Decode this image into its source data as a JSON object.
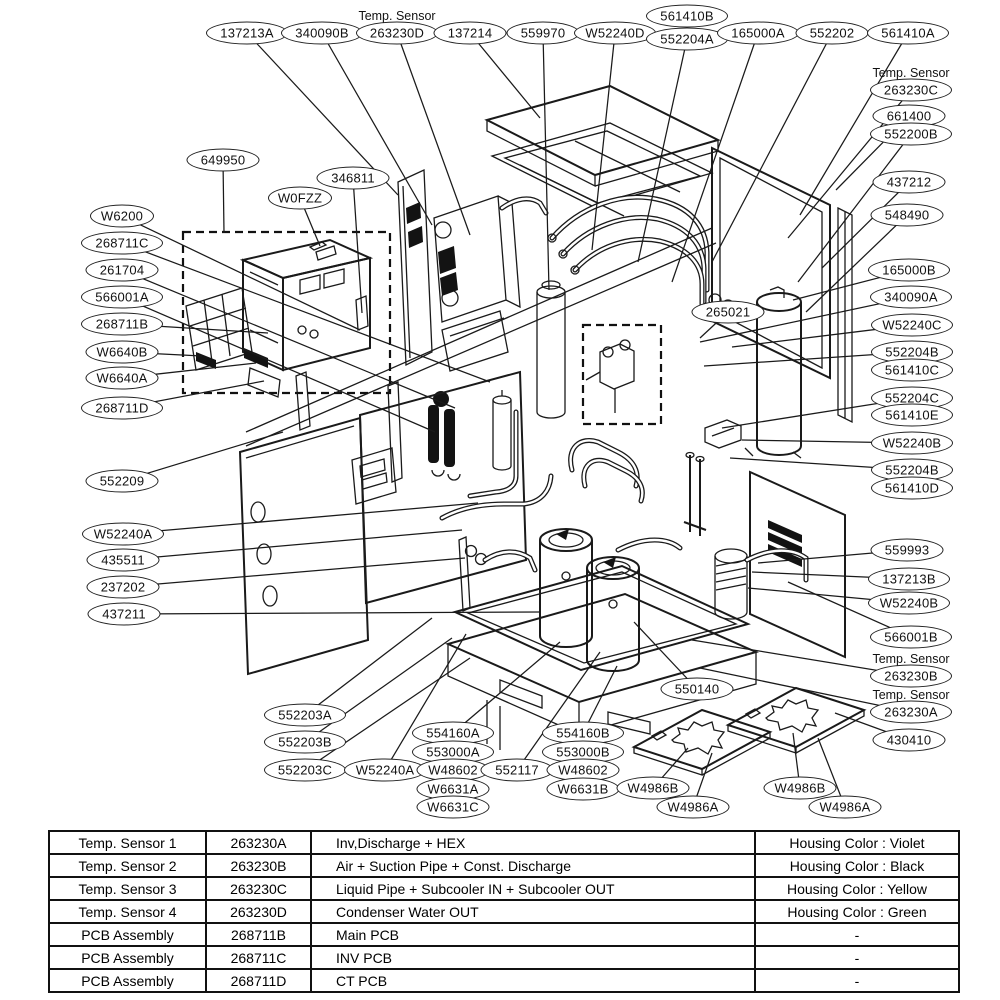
{
  "diagram": {
    "sensor_note_text": "Temp. Sensor",
    "labels": [
      {
        "text": "137213A",
        "x": 247,
        "y": 33,
        "lx": 398,
        "ly": 195
      },
      {
        "text": "340090B",
        "x": 322,
        "y": 33,
        "lx": 432,
        "ly": 225
      },
      {
        "text": "263230D",
        "x": 397,
        "y": 33,
        "note": true,
        "lx": 470,
        "ly": 235
      },
      {
        "text": "137214",
        "x": 470,
        "y": 33,
        "lx": 540,
        "ly": 118
      },
      {
        "text": "559970",
        "x": 543,
        "y": 33,
        "lx": 549,
        "ly": 290
      },
      {
        "text": "W52240D",
        "x": 615,
        "y": 33,
        "lx": 592,
        "ly": 250
      },
      {
        "text": "561410B",
        "x": 687,
        "y": 16
      },
      {
        "text": "552204A",
        "x": 687,
        "y": 39,
        "lx": 638,
        "ly": 262
      },
      {
        "text": "165000A",
        "x": 758,
        "y": 33,
        "lx": 672,
        "ly": 282
      },
      {
        "text": "552202",
        "x": 832,
        "y": 33,
        "lx": 712,
        "ly": 262
      },
      {
        "text": "561410A",
        "x": 908,
        "y": 33,
        "lx": 800,
        "ly": 215
      },
      {
        "text": "263230C",
        "x": 911,
        "y": 90,
        "note": true,
        "lx": 788,
        "ly": 238
      },
      {
        "text": "661400",
        "x": 909,
        "y": 116,
        "lx": 836,
        "ly": 190
      },
      {
        "text": "552200B",
        "x": 911,
        "y": 134,
        "lx": 798,
        "ly": 282
      },
      {
        "text": "437212",
        "x": 909,
        "y": 182,
        "lx": 822,
        "ly": 268
      },
      {
        "text": "548490",
        "x": 907,
        "y": 215,
        "lx": 806,
        "ly": 312
      },
      {
        "text": "165000B",
        "x": 909,
        "y": 270,
        "lx": 793,
        "ly": 300
      },
      {
        "text": "340090A",
        "x": 911,
        "y": 297,
        "lx": 700,
        "ly": 342
      },
      {
        "text": "W52240C",
        "x": 912,
        "y": 325,
        "lx": 732,
        "ly": 347
      },
      {
        "text": "552204B",
        "x": 912,
        "y": 352,
        "lx": 704,
        "ly": 366
      },
      {
        "text": "561410C",
        "x": 912,
        "y": 370
      },
      {
        "text": "552204C",
        "x": 912,
        "y": 398,
        "lx": 722,
        "ly": 428
      },
      {
        "text": "561410E",
        "x": 912,
        "y": 415
      },
      {
        "text": "W52240B",
        "x": 912,
        "y": 443,
        "lx": 742,
        "ly": 440
      },
      {
        "text": "552204B",
        "x": 912,
        "y": 470,
        "lx": 730,
        "ly": 458
      },
      {
        "text": "561410D",
        "x": 912,
        "y": 488
      },
      {
        "text": "559993",
        "x": 907,
        "y": 550,
        "lx": 758,
        "ly": 563
      },
      {
        "text": "137213B",
        "x": 909,
        "y": 579,
        "lx": 752,
        "ly": 572
      },
      {
        "text": "W52240B",
        "x": 909,
        "y": 603,
        "lx": 748,
        "ly": 588
      },
      {
        "text": "566001B",
        "x": 911,
        "y": 637,
        "lx": 788,
        "ly": 582
      },
      {
        "text": "263230B",
        "x": 911,
        "y": 676,
        "note": true,
        "lx": 692,
        "ly": 640
      },
      {
        "text": "263230A",
        "x": 911,
        "y": 712,
        "note": true,
        "lx": 700,
        "ly": 668
      },
      {
        "text": "430410",
        "x": 909,
        "y": 740,
        "lx": 835,
        "ly": 713
      },
      {
        "text": "649950",
        "x": 223,
        "y": 160,
        "lx": 224,
        "ly": 233
      },
      {
        "text": "346811",
        "x": 353,
        "y": 178,
        "lx": 362,
        "ly": 313
      },
      {
        "text": "W0FZZ",
        "x": 300,
        "y": 198,
        "lx": 320,
        "ly": 246
      },
      {
        "text": "W6200",
        "x": 122,
        "y": 216,
        "lx": 360,
        "ly": 330
      },
      {
        "text": "268711C",
        "x": 122,
        "y": 243,
        "lx": 490,
        "ly": 382
      },
      {
        "text": "261704",
        "x": 122,
        "y": 270,
        "lx": 455,
        "ly": 408
      },
      {
        "text": "566001A",
        "x": 122,
        "y": 297,
        "lx": 435,
        "ly": 432
      },
      {
        "text": "268711B",
        "x": 122,
        "y": 324,
        "lx": 268,
        "ly": 333
      },
      {
        "text": "W6640B",
        "x": 122,
        "y": 352,
        "lx": 202,
        "ly": 356
      },
      {
        "text": "W6640A",
        "x": 122,
        "y": 378,
        "lx": 256,
        "ly": 363
      },
      {
        "text": "268711D",
        "x": 122,
        "y": 408,
        "lx": 264,
        "ly": 381
      },
      {
        "text": "552209",
        "x": 122,
        "y": 481,
        "lx": 283,
        "ly": 432
      },
      {
        "text": "W52240A",
        "x": 123,
        "y": 534,
        "lx": 478,
        "ly": 503
      },
      {
        "text": "435511",
        "x": 123,
        "y": 560,
        "lx": 462,
        "ly": 530
      },
      {
        "text": "237202",
        "x": 123,
        "y": 587,
        "lx": 465,
        "ly": 558
      },
      {
        "text": "437211",
        "x": 124,
        "y": 614,
        "lx": 540,
        "ly": 612
      },
      {
        "text": "552203A",
        "x": 305,
        "y": 715,
        "lx": 432,
        "ly": 618
      },
      {
        "text": "552203B",
        "x": 305,
        "y": 742,
        "lx": 452,
        "ly": 638
      },
      {
        "text": "552203C",
        "x": 305,
        "y": 770,
        "lx": 470,
        "ly": 658
      },
      {
        "text": "W52240A",
        "x": 385,
        "y": 770,
        "lx": 466,
        "ly": 634
      },
      {
        "text": "554160A",
        "x": 453,
        "y": 733,
        "lx": 560,
        "ly": 642
      },
      {
        "text": "553000A",
        "x": 453,
        "y": 752
      },
      {
        "text": "W48602",
        "x": 453,
        "y": 770
      },
      {
        "text": "W6631A",
        "x": 453,
        "y": 789
      },
      {
        "text": "W6631C",
        "x": 453,
        "y": 807
      },
      {
        "text": "552117",
        "x": 517,
        "y": 770,
        "lx": 600,
        "ly": 652
      },
      {
        "text": "554160B",
        "x": 583,
        "y": 733,
        "lx": 617,
        "ly": 666
      },
      {
        "text": "553000B",
        "x": 583,
        "y": 752
      },
      {
        "text": "W48602",
        "x": 583,
        "y": 770
      },
      {
        "text": "W6631B",
        "x": 583,
        "y": 789
      },
      {
        "text": "550140",
        "x": 697,
        "y": 689,
        "lx": 634,
        "ly": 622
      },
      {
        "text": "265021",
        "x": 728,
        "y": 312,
        "lx": 700,
        "ly": 338
      },
      {
        "text": "W4986B",
        "x": 653,
        "y": 788,
        "lx": 688,
        "ly": 748
      },
      {
        "text": "W4986A",
        "x": 693,
        "y": 807,
        "lx": 712,
        "ly": 753
      },
      {
        "text": "W4986B",
        "x": 800,
        "y": 788,
        "lx": 793,
        "ly": 733
      },
      {
        "text": "W4986A",
        "x": 845,
        "y": 807,
        "lx": 818,
        "ly": 738
      }
    ]
  },
  "table": {
    "rows": [
      [
        "Temp. Sensor 1",
        "263230A",
        "Inv,Discharge + HEX",
        "Housing Color : Violet"
      ],
      [
        "Temp. Sensor 2",
        "263230B",
        "Air + Suction Pipe + Const. Discharge",
        "Housing Color : Black"
      ],
      [
        "Temp. Sensor 3",
        "263230C",
        "Liquid Pipe + Subcooler IN + Subcooler OUT",
        "Housing Color : Yellow"
      ],
      [
        "Temp. Sensor 4",
        "263230D",
        "Condenser Water OUT",
        "Housing Color : Green"
      ],
      [
        "PCB Assembly",
        "268711B",
        "Main PCB",
        "-"
      ],
      [
        "PCB Assembly",
        "268711C",
        "INV PCB",
        "-"
      ],
      [
        "PCB Assembly",
        "268711D",
        "CT PCB",
        "-"
      ]
    ]
  }
}
